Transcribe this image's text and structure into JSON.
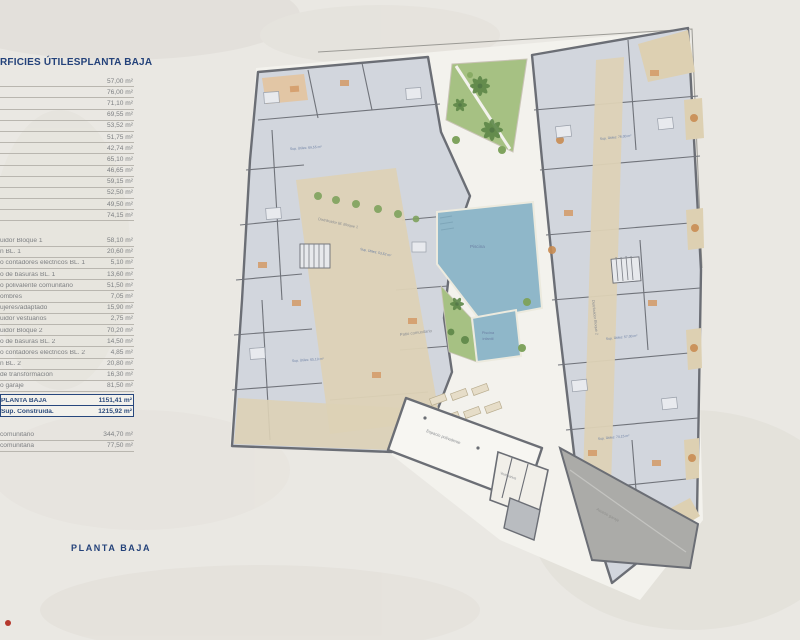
{
  "page": {
    "background_color": "#eae8e3",
    "accent_navy": "#24427a"
  },
  "table": {
    "header": {
      "left": "RFICIES ÚTILES",
      "right": "PLANTA BAJA"
    },
    "unit": "m²",
    "group1": [
      {
        "label": "",
        "value": "57,00 m²"
      },
      {
        "label": "",
        "value": "76,00 m²"
      },
      {
        "label": "",
        "value": "71,10 m²"
      },
      {
        "label": "",
        "value": "69,55 m²"
      },
      {
        "label": "",
        "value": "53,52 m²"
      },
      {
        "label": "",
        "value": "51,75 m²"
      },
      {
        "label": "",
        "value": "42,74 m²"
      },
      {
        "label": "",
        "value": "65,10 m²"
      },
      {
        "label": "",
        "value": "46,65 m²"
      },
      {
        "label": "",
        "value": "59,15 m²"
      },
      {
        "label": "",
        "value": "52,50 m²"
      },
      {
        "label": "",
        "value": "49,50 m²"
      },
      {
        "label": "",
        "value": "74,15 m²"
      }
    ],
    "group2": [
      {
        "label": "uidor Bloque 1",
        "value": "58,10 m²"
      },
      {
        "label": "n BL. 1",
        "value": "20,60 m²"
      },
      {
        "label": "o contadores eléctricos BL. 1",
        "value": "5,10 m²"
      },
      {
        "label": "o de basuras BL. 1",
        "value": "13,60 m²"
      },
      {
        "label": "o polivalente comunitario",
        "value": "51,50 m²"
      },
      {
        "label": "ombres",
        "value": "7,05 m²"
      },
      {
        "label": "ujeres/adaptado",
        "value": "15,90 m²"
      },
      {
        "label": "uidor vestuarios",
        "value": "2,75 m²"
      },
      {
        "label": "uidor Bloque 2",
        "value": "70,20 m²"
      },
      {
        "label": "o de basuras BL. 2",
        "value": "14,50 m²"
      },
      {
        "label": "o contadores eléctricos BL. 2",
        "value": "4,85 m²"
      },
      {
        "label": "n BL. 2",
        "value": "20,80 m²"
      },
      {
        "label": "de transformación",
        "value": "16,30 m²"
      },
      {
        "label": "o garaje",
        "value": "81,50 m²"
      }
    ],
    "summary": [
      {
        "label": "PLANTA BAJA",
        "value": "1151,41 m²"
      },
      {
        "label": "Sup. Construida.",
        "value": "1215,92 m²"
      }
    ],
    "group3": [
      {
        "label": "comunitario",
        "value": "344,70 m²"
      },
      {
        "label": "comunitaria",
        "value": "77,50 m²"
      }
    ]
  },
  "footer_title": "PLANTA BAJA",
  "plan": {
    "labels": {
      "pool": "Piscina",
      "kids_pool_line1": "Piscina",
      "kids_pool_line2": "infantil",
      "patio": "Patio comunitario",
      "hall": "Espacio polivalente",
      "vestuarios": "Vestuarios",
      "ramp": "Acceso garaje",
      "dist1": "Distribuidor Bl. Bloque 1",
      "dist2": "Distribuidor Bloque 2"
    },
    "room_labels": [
      "Sup. Útiles: 69,55 m²",
      "Sup. Útiles: 53,52 m²",
      "Sup. Útiles: 76,00 m²",
      "Sup. Útiles: 57,00 m²",
      "Sup. Útiles: 74,15 m²",
      "Sup. Útiles: 65,10 m²"
    ],
    "colors": {
      "apartment_fill": "#d2d6dd",
      "wall": "#6b6e75",
      "communal_beige": "#ddd2b6",
      "garden_green": "#a6c183",
      "palm_green": "#5d8748",
      "pool_blue": "#8fb7c9",
      "ramp_gray": "#ababa8",
      "label_blue": "#6b7fa3"
    }
  }
}
